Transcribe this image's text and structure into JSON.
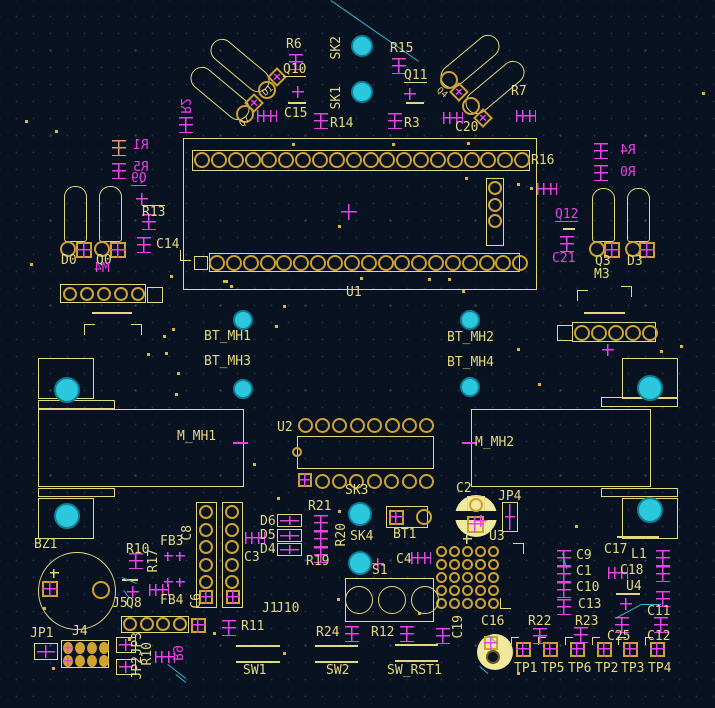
{
  "app": {
    "title": "PCB layout canvas"
  },
  "colors": {
    "background": "#081220",
    "silkscreen": "#e3d87e",
    "pad_gold": "#d0a331",
    "back_silk_magenta": "#e743e7",
    "highlight_salmon": "#e09478",
    "hole_cyan": "#2bc7dc",
    "ratsnest_cyan": "#3eb4c8",
    "pad_fill_pale": "#f0e89c"
  },
  "labels": [
    {
      "t": "R6",
      "x": 286,
      "y": 39
    },
    {
      "t": "Q10",
      "x": 283,
      "y": 64,
      "u": 1
    },
    {
      "t": "SK2",
      "x": 330,
      "y": 36,
      "v": 1
    },
    {
      "t": "SK1",
      "x": 330,
      "y": 86,
      "v": 1
    },
    {
      "t": "R15",
      "x": 390,
      "y": 43
    },
    {
      "t": "Q11",
      "x": 404,
      "y": 70,
      "u": 1
    },
    {
      "t": "R7",
      "x": 511,
      "y": 86
    },
    {
      "t": "C15",
      "x": 284,
      "y": 108
    },
    {
      "t": "R14",
      "x": 330,
      "y": 118
    },
    {
      "t": "R3",
      "x": 404,
      "y": 118
    },
    {
      "t": "C20",
      "x": 455,
      "y": 122
    },
    {
      "t": "D1",
      "x": 263,
      "y": 86,
      "fs": 9,
      "r": -40
    },
    {
      "t": "Q7",
      "x": 240,
      "y": 117,
      "fs": 9,
      "r": -40
    },
    {
      "t": "Q4",
      "x": 436,
      "y": 88,
      "fs": 9,
      "r": 40
    },
    {
      "t": "R2",
      "x": 178,
      "y": 98,
      "c": "m",
      "v": 1,
      "mir": 1
    },
    {
      "t": "R1",
      "x": 133,
      "y": 140,
      "c": "m",
      "mir": 1
    },
    {
      "t": "R5",
      "x": 133,
      "y": 162,
      "c": "m",
      "mir": 1
    },
    {
      "t": "Q9",
      "x": 131,
      "y": 173,
      "c": "m",
      "mir": 1,
      "u": 1
    },
    {
      "t": "R13",
      "x": 142,
      "y": 205,
      "o": 1
    },
    {
      "t": "C14",
      "x": 156,
      "y": 239
    },
    {
      "t": "D0",
      "x": 61,
      "y": 255
    },
    {
      "t": "Q0",
      "x": 96,
      "y": 255
    },
    {
      "t": "M4",
      "x": 94,
      "y": 263,
      "c": "m",
      "mir": 1
    },
    {
      "t": "R16",
      "x": 531,
      "y": 155
    },
    {
      "t": "R4",
      "x": 620,
      "y": 145,
      "c": "m",
      "mir": 1
    },
    {
      "t": "R0",
      "x": 620,
      "y": 167,
      "c": "m",
      "mir": 1
    },
    {
      "t": "Q12",
      "x": 555,
      "y": 209,
      "c": "m",
      "u": 1
    },
    {
      "t": "C21",
      "x": 552,
      "y": 253,
      "c": "m"
    },
    {
      "t": "Q3",
      "x": 595,
      "y": 256
    },
    {
      "t": "D3",
      "x": 627,
      "y": 256
    },
    {
      "t": "M3",
      "x": 594,
      "y": 269
    },
    {
      "t": "U1",
      "x": 346,
      "y": 287
    },
    {
      "t": "BT_MH1",
      "x": 204,
      "y": 331
    },
    {
      "t": "BT_MH3",
      "x": 204,
      "y": 356
    },
    {
      "t": "BT_MH2",
      "x": 447,
      "y": 332
    },
    {
      "t": "BT_MH4",
      "x": 447,
      "y": 357
    },
    {
      "t": "M_MH1",
      "x": 177,
      "y": 431
    },
    {
      "t": "M_MH2",
      "x": 475,
      "y": 437
    },
    {
      "t": "U2",
      "x": 277,
      "y": 422
    },
    {
      "t": "SK3",
      "x": 345,
      "y": 485
    },
    {
      "t": "R21",
      "x": 308,
      "y": 501
    },
    {
      "t": "R19",
      "x": 306,
      "y": 556
    },
    {
      "t": "R20",
      "x": 335,
      "y": 523,
      "v": 1
    },
    {
      "t": "SK4",
      "x": 350,
      "y": 531
    },
    {
      "t": "BT1",
      "x": 393,
      "y": 529
    },
    {
      "t": "C2",
      "x": 456,
      "y": 483
    },
    {
      "t": "JP4",
      "x": 498,
      "y": 491
    },
    {
      "t": "U3",
      "x": 489,
      "y": 531
    },
    {
      "t": "C4",
      "x": 396,
      "y": 554
    },
    {
      "t": "S1",
      "x": 372,
      "y": 565
    },
    {
      "t": "C3",
      "x": 244,
      "y": 552
    },
    {
      "t": "D6",
      "x": 260,
      "y": 516
    },
    {
      "t": "D5",
      "x": 260,
      "y": 530
    },
    {
      "t": "D4",
      "x": 260,
      "y": 544
    },
    {
      "t": "J1",
      "x": 262,
      "y": 603
    },
    {
      "t": "J10",
      "x": 276,
      "y": 603
    },
    {
      "t": "R11",
      "x": 241,
      "y": 621
    },
    {
      "t": "R24",
      "x": 316,
      "y": 627
    },
    {
      "t": "R12",
      "x": 371,
      "y": 627
    },
    {
      "t": "SW1",
      "x": 243,
      "y": 665
    },
    {
      "t": "SW2",
      "x": 326,
      "y": 665
    },
    {
      "t": "SW_RST1",
      "x": 387,
      "y": 665
    },
    {
      "t": "C19",
      "x": 452,
      "y": 615,
      "v": 1
    },
    {
      "t": "C16",
      "x": 481,
      "y": 616
    },
    {
      "t": "R22",
      "x": 528,
      "y": 616
    },
    {
      "t": "R23",
      "x": 575,
      "y": 616
    },
    {
      "t": "C25",
      "x": 607,
      "y": 631
    },
    {
      "t": "C12",
      "x": 647,
      "y": 631
    },
    {
      "t": "C9",
      "x": 576,
      "y": 550
    },
    {
      "t": "C1",
      "x": 576,
      "y": 566
    },
    {
      "t": "C10",
      "x": 576,
      "y": 582
    },
    {
      "t": "C13",
      "x": 578,
      "y": 599
    },
    {
      "t": "C17",
      "x": 604,
      "y": 544
    },
    {
      "t": "L1",
      "x": 631,
      "y": 549
    },
    {
      "t": "C18",
      "x": 620,
      "y": 565
    },
    {
      "t": "U4",
      "x": 626,
      "y": 581
    },
    {
      "t": "C11",
      "x": 647,
      "y": 606
    },
    {
      "t": "TP1",
      "x": 514,
      "y": 663
    },
    {
      "t": "TP5",
      "x": 541,
      "y": 663
    },
    {
      "t": "TP6",
      "x": 568,
      "y": 663
    },
    {
      "t": "TP2",
      "x": 595,
      "y": 663
    },
    {
      "t": "TP3",
      "x": 621,
      "y": 663
    },
    {
      "t": "TP4",
      "x": 648,
      "y": 663
    },
    {
      "t": "BZ1",
      "x": 34,
      "y": 539
    },
    {
      "t": "R10",
      "x": 126,
      "y": 544
    },
    {
      "t": "R17",
      "x": 147,
      "y": 549,
      "v": 1
    },
    {
      "t": "FB3",
      "x": 160,
      "y": 536
    },
    {
      "t": "FB4",
      "x": 160,
      "y": 595
    },
    {
      "t": "C6",
      "x": 190,
      "y": 593,
      "v": 1
    },
    {
      "t": "C8",
      "x": 181,
      "y": 525,
      "v": 1
    },
    {
      "t": "J5",
      "x": 112,
      "y": 598
    },
    {
      "t": "Q8",
      "x": 126,
      "y": 598
    },
    {
      "t": "JP1",
      "x": 30,
      "y": 628
    },
    {
      "t": "J4",
      "x": 72,
      "y": 626
    },
    {
      "t": "JP3",
      "x": 131,
      "y": 632,
      "v": 1
    },
    {
      "t": "JP2",
      "x": 131,
      "y": 656,
      "v": 1
    },
    {
      "t": "R10",
      "x": 141,
      "y": 642,
      "v": 1
    },
    {
      "t": "R9",
      "x": 170,
      "y": 645,
      "c": "m",
      "v": 1,
      "mir": 1
    }
  ],
  "rects": [
    [
      183,
      138,
      354,
      152
    ],
    [
      192,
      150,
      338,
      21
    ],
    [
      209,
      253,
      311,
      19
    ],
    [
      486,
      178,
      18,
      68
    ],
    [
      60,
      284,
      86,
      19
    ],
    [
      147,
      287,
      16,
      16
    ],
    [
      572,
      322,
      84,
      20
    ],
    [
      557,
      325,
      16,
      16
    ],
    [
      297,
      436,
      137,
      33
    ],
    [
      196,
      502,
      21,
      106
    ],
    [
      222,
      502,
      21,
      106
    ],
    [
      121,
      616,
      68,
      17
    ],
    [
      345,
      578,
      89,
      44
    ],
    [
      386,
      506,
      42,
      22
    ],
    [
      61,
      640,
      48,
      28
    ],
    [
      38,
      358,
      56,
      41
    ],
    [
      38,
      400,
      77,
      9
    ],
    [
      38,
      409,
      206,
      78
    ],
    [
      38,
      488,
      77,
      9
    ],
    [
      38,
      498,
      56,
      41
    ],
    [
      622,
      358,
      56,
      41
    ],
    [
      601,
      397,
      77,
      10
    ],
    [
      471,
      409,
      180,
      78
    ],
    [
      601,
      488,
      77,
      9
    ],
    [
      622,
      498,
      56,
      41
    ],
    [
      467,
      496,
      18,
      18
    ],
    [
      194,
      256,
      14,
      14
    ]
  ],
  "circles": [
    [
      77,
      591,
      39
    ]
  ],
  "discs": [
    {
      "x": 476,
      "y": 516,
      "r": 21,
      "band": [
        455,
        511,
        42,
        9
      ]
    },
    {
      "x": 495,
      "y": 652,
      "r": 18,
      "band": null
    }
  ],
  "stadiums": [
    [
      185,
      82,
      70,
      23,
      40
    ],
    [
      205,
      54,
      70,
      23,
      40
    ],
    [
      435,
      50,
      70,
      23,
      -40
    ],
    [
      460,
      76,
      70,
      23,
      -40
    ]
  ],
  "bulbs": [
    [
      64,
      186,
      23,
      56
    ],
    [
      99,
      186,
      23,
      56
    ],
    [
      592,
      188,
      23,
      54
    ],
    [
      627,
      188,
      23,
      54
    ]
  ],
  "padrows": [
    {
      "x": 202,
      "y": 160,
      "n": 20,
      "dx": 16.85,
      "dy": 0,
      "r": 8
    },
    {
      "x": 217,
      "y": 263,
      "n": 19,
      "dx": 16.85,
      "dy": 0,
      "r": 8
    },
    {
      "x": 495,
      "y": 188,
      "n": 3,
      "dx": 0,
      "dy": 16.5,
      "r": 7
    },
    {
      "x": 70,
      "y": 294,
      "n": 5,
      "dx": 17,
      "dy": 0,
      "r": 7
    },
    {
      "x": 582,
      "y": 333,
      "n": 5,
      "dx": 17,
      "dy": 0,
      "r": 8
    },
    {
      "x": 305,
      "y": 425,
      "n": 8,
      "dx": 17.4,
      "dy": 0,
      "r": 7.5
    },
    {
      "x": 322,
      "y": 481,
      "n": 7,
      "dx": 17.4,
      "dy": 0,
      "r": 7.5
    },
    {
      "x": 206,
      "y": 512,
      "n": 5,
      "dx": 0,
      "dy": 17.5,
      "r": 7
    },
    {
      "x": 232,
      "y": 512,
      "n": 5,
      "dx": 0,
      "dy": 17.5,
      "r": 7
    },
    {
      "x": 130,
      "y": 624,
      "n": 4,
      "dx": 16.5,
      "dy": 0,
      "r": 7
    },
    {
      "x": 441,
      "y": 551,
      "n": 5,
      "rows": 5,
      "dx": 13,
      "dy": 13.2,
      "r": 5.5
    },
    {
      "x": 359,
      "y": 600,
      "n": 3,
      "dx": 33,
      "dy": 0,
      "r": 14,
      "thin": 1
    }
  ],
  "rings": [
    [
      245,
      114,
      9
    ],
    [
      267,
      90,
      9
    ],
    [
      449,
      80,
      9
    ],
    [
      471,
      106,
      9
    ],
    [
      68,
      249,
      8
    ],
    [
      102,
      249,
      8
    ],
    [
      597,
      249,
      8
    ],
    [
      633,
      249,
      8
    ],
    [
      101,
      590,
      9
    ],
    [
      424,
      517,
      8
    ],
    [
      476,
      505,
      7
    ],
    [
      297,
      452,
      5
    ]
  ],
  "darkrings": [
    [
      493,
      657,
      7
    ]
  ],
  "diamonds": [
    [
      254,
      103
    ],
    [
      277,
      77
    ],
    [
      459,
      92
    ],
    [
      483,
      118
    ]
  ],
  "sqpads": [
    [
      84,
      250,
      16
    ],
    [
      118,
      250,
      16
    ],
    [
      612,
      250,
      16
    ],
    [
      647,
      250,
      16
    ],
    [
      305,
      480,
      14
    ],
    [
      206,
      597,
      14
    ],
    [
      233,
      597,
      14
    ],
    [
      198,
      625,
      15
    ],
    [
      396,
      517,
      15
    ],
    [
      475,
      524,
      17
    ],
    [
      491,
      643,
      14
    ],
    [
      50,
      589,
      16
    ]
  ],
  "tps": [
    [
      523,
      649
    ],
    [
      550,
      649
    ],
    [
      577,
      649
    ],
    [
      604,
      649
    ],
    [
      630,
      649
    ],
    [
      657,
      649
    ]
  ],
  "crossboxes": [
    [
      34,
      643,
      24,
      17
    ],
    [
      116,
      637,
      20,
      16
    ],
    [
      116,
      659,
      20,
      16
    ],
    [
      502,
      502,
      16,
      30
    ],
    [
      277,
      514,
      25,
      13
    ],
    [
      277,
      529,
      25,
      13
    ],
    [
      277,
      543,
      25,
      13
    ]
  ],
  "holes": [
    [
      362,
      46,
      11
    ],
    [
      362,
      92,
      11
    ],
    [
      243,
      320,
      10
    ],
    [
      243,
      389,
      10
    ],
    [
      470,
      320,
      10
    ],
    [
      470,
      387,
      10
    ],
    [
      67,
      390,
      13
    ],
    [
      67,
      516,
      13
    ],
    [
      650,
      388,
      13
    ],
    [
      650,
      510,
      13
    ],
    [
      360,
      514,
      12
    ],
    [
      360,
      563,
      12
    ]
  ],
  "rsyms": [
    [
      289,
      54
    ],
    [
      392,
      58
    ],
    [
      112,
      140,
      "s"
    ],
    [
      112,
      163
    ],
    [
      179,
      117
    ],
    [
      314,
      113
    ],
    [
      388,
      113
    ],
    [
      142,
      214
    ],
    [
      137,
      237
    ],
    [
      594,
      143
    ],
    [
      594,
      165
    ],
    [
      560,
      236
    ],
    [
      129,
      553
    ],
    [
      314,
      515
    ],
    [
      314,
      531
    ],
    [
      314,
      547
    ],
    [
      222,
      620
    ],
    [
      345,
      626
    ],
    [
      400,
      626
    ],
    [
      436,
      628
    ],
    [
      533,
      628
    ],
    [
      574,
      627
    ],
    [
      615,
      617
    ],
    [
      654,
      617
    ],
    [
      557,
      550
    ],
    [
      557,
      566
    ],
    [
      557,
      582
    ],
    [
      557,
      599
    ],
    [
      656,
      550
    ],
    [
      656,
      566
    ],
    [
      656,
      591
    ]
  ],
  "hsyms": [
    [
      257,
      110
    ],
    [
      443,
      112
    ],
    [
      516,
      110
    ],
    [
      537,
      183
    ],
    [
      411,
      552
    ],
    [
      608,
      567
    ],
    [
      149,
      584
    ],
    [
      245,
      532
    ],
    [
      155,
      651
    ]
  ],
  "crosses": [
    [
      298,
      92,
      12
    ],
    [
      410,
      94,
      12
    ],
    [
      142,
      199,
      12
    ],
    [
      349,
      212,
      16
    ],
    [
      378,
      564,
      12
    ],
    [
      481,
      521,
      12
    ],
    [
      133,
      592,
      12
    ],
    [
      608,
      350,
      12
    ],
    [
      626,
      604,
      12
    ],
    [
      168,
      556,
      9
    ],
    [
      180,
      556,
      9
    ],
    [
      168,
      582,
      9
    ],
    [
      180,
      582,
      9
    ],
    [
      68,
      648,
      9
    ],
    [
      68,
      661,
      9
    ],
    [
      54,
      573,
      9,
      "y"
    ],
    [
      467,
      539,
      9,
      "y"
    ]
  ],
  "lines": [
    [
      288,
      102,
      18
    ],
    [
      406,
      102,
      18
    ],
    [
      563,
      228,
      12
    ],
    [
      92,
      312,
      40
    ],
    [
      584,
      312,
      41
    ],
    [
      122,
      579,
      16
    ],
    [
      616,
      593,
      24
    ],
    [
      617,
      536,
      42
    ],
    [
      236,
      645,
      44
    ],
    [
      236,
      661,
      44
    ],
    [
      315,
      645,
      43
    ],
    [
      315,
      661,
      43
    ],
    [
      395,
      644,
      43
    ],
    [
      395,
      660,
      43
    ],
    [
      233,
      442,
      15,
      "m"
    ],
    [
      462,
      442,
      15,
      "m"
    ]
  ],
  "corners": [
    [
      84,
      324,
      "tl"
    ],
    [
      131,
      324,
      "tr"
    ],
    [
      577,
      290,
      "tl"
    ],
    [
      621,
      286,
      "tr"
    ],
    [
      513,
      543,
      "tr"
    ],
    [
      500,
      598,
      "bl"
    ],
    [
      180,
      250,
      "bl"
    ]
  ],
  "ovalgrid": {
    "x0": 68,
    "y0": 648,
    "dx": 12,
    "dy": 13,
    "cols": 4,
    "rows": 2,
    "rx": 5,
    "ry": 6
  },
  "airwires": [
    [
      331,
      0,
      419,
      61
    ],
    [
      563,
      553,
      567,
      568
    ],
    [
      122,
      577,
      137,
      583
    ],
    [
      124,
      590,
      130,
      598
    ],
    [
      168,
      664,
      186,
      678
    ],
    [
      617,
      617,
      641,
      604
    ],
    [
      641,
      604,
      661,
      604
    ],
    [
      480,
      666,
      488,
      673
    ],
    [
      489,
      635,
      497,
      643
    ],
    [
      176,
      674,
      186,
      682
    ]
  ],
  "dots": [
    [
      292,
      143
    ],
    [
      392,
      143
    ],
    [
      467,
      142
    ],
    [
      465,
      177
    ],
    [
      517,
      183
    ],
    [
      530,
      187
    ],
    [
      338,
      225
    ],
    [
      223,
      280
    ],
    [
      230,
      285
    ],
    [
      360,
      277
    ],
    [
      428,
      278
    ],
    [
      448,
      278
    ],
    [
      462,
      290
    ],
    [
      170,
      275
    ],
    [
      225,
      280
    ],
    [
      283,
      305
    ],
    [
      275,
      325
    ],
    [
      163,
      335
    ],
    [
      172,
      328
    ],
    [
      147,
      353
    ],
    [
      177,
      372
    ],
    [
      165,
      352
    ],
    [
      175,
      393
    ],
    [
      253,
      463
    ],
    [
      517,
      348
    ],
    [
      538,
      383
    ],
    [
      575,
      525
    ],
    [
      338,
      510
    ],
    [
      337,
      598
    ],
    [
      418,
      612
    ],
    [
      43,
      607
    ],
    [
      128,
      638
    ],
    [
      52,
      667
    ],
    [
      517,
      672
    ],
    [
      277,
      497
    ],
    [
      213,
      632
    ],
    [
      283,
      652
    ],
    [
      25,
      120
    ],
    [
      680,
      345
    ],
    [
      660,
      350
    ],
    [
      702,
      92
    ],
    [
      30,
      263
    ],
    [
      55,
      130
    ]
  ]
}
